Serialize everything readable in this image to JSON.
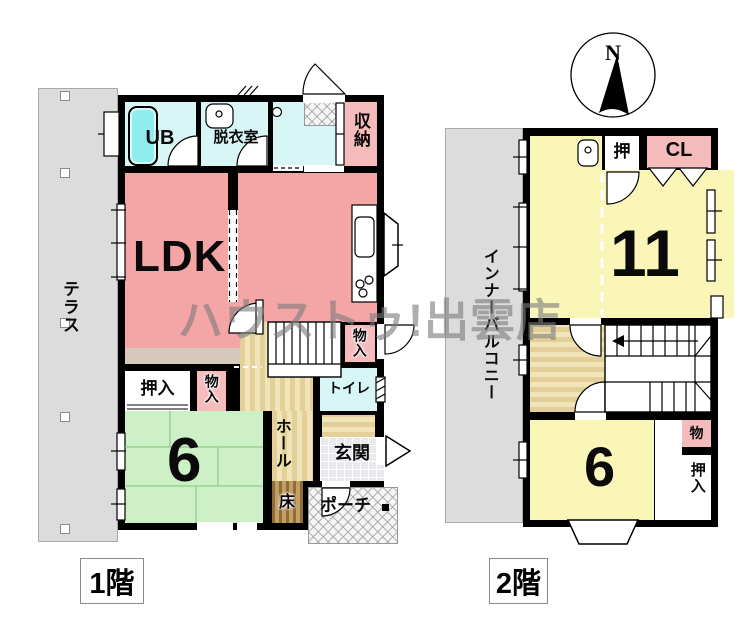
{
  "watermark": {
    "text": "ハウストゥ!出雲店"
  },
  "compass": {
    "north": "N"
  },
  "floor1": {
    "label": "1階",
    "terrace": "テラス",
    "ub": "UB",
    "dressing_room": "脱衣室",
    "storage": "収納",
    "ldk": "LDK",
    "closet": "押入",
    "cupboard": "物入",
    "tatami_count": "6",
    "stair_cupboard": "物入",
    "toilet": "トイレ",
    "hall": "ホール",
    "entrance": "玄関",
    "alcove": "床",
    "porch": "ポーチ"
  },
  "floor2": {
    "label": "2階",
    "balcony": "インナーバルコニー",
    "closet_small": "押",
    "closet_cl": "CL",
    "room_large": "11",
    "room_small": "6",
    "storage": "物",
    "closet": "押入"
  },
  "colors": {
    "wall": "#000000",
    "room_pink": "#f4a6a6",
    "closet_pink": "#f6bcbc",
    "room_cyan": "#d9f6f6",
    "room_yellow": "#f9f6b8",
    "room_green": "#cdf0c7",
    "floor_tan": "#e8d7a4",
    "terrace_gray": "#dcdcdc"
  }
}
